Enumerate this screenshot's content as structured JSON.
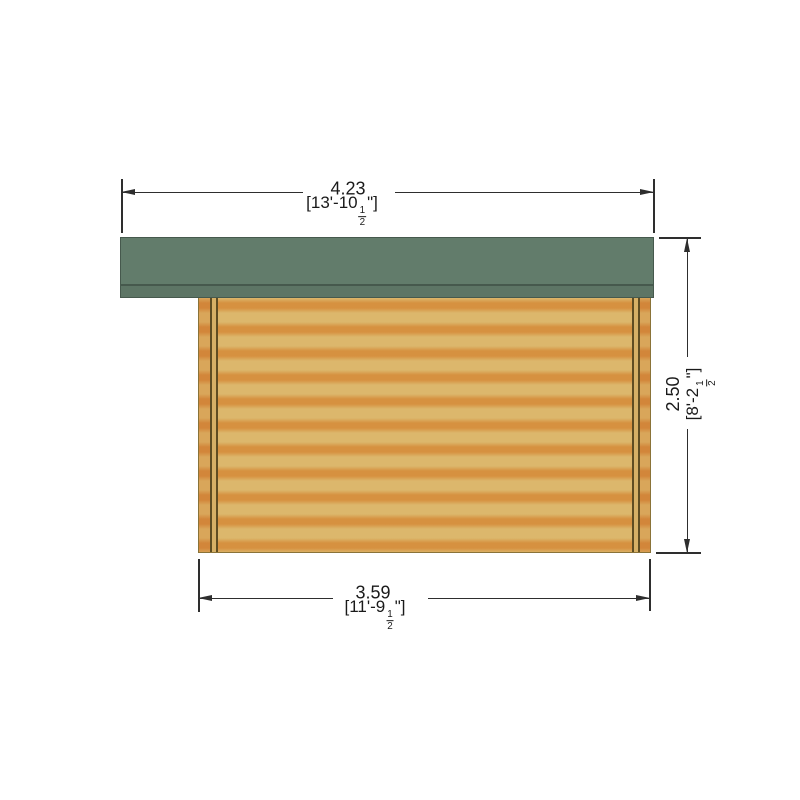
{
  "colors": {
    "background": "#ffffff",
    "roof": "#627c6b",
    "roof_fascia": "#5d7565",
    "roof_edge": "#46594d",
    "wall_light": "#dcb76c",
    "wall_dark": "#d69140",
    "wall_end_light": "#d9a65a",
    "wall_end_dark": "#d2863a",
    "wall_outline": "#8a7338",
    "groove_line": "#5f4d22",
    "groove_fill": "#d6b066",
    "dim": "#2e2e2e",
    "text": "#1a1a1a"
  },
  "dimensions": {
    "top_width": {
      "metric": "4.23",
      "imperial_prefix": "[13'-10",
      "fraction_numerator": "1",
      "fraction_denominator": "2",
      "imperial_suffix": "\"]"
    },
    "right_height": {
      "metric": "2.50",
      "imperial_prefix": "[8'-2",
      "fraction_numerator": "1",
      "fraction_denominator": "2",
      "imperial_suffix": "\"]"
    },
    "bottom_width": {
      "metric": "3.59",
      "imperial_prefix": "[11'-9",
      "fraction_numerator": "1",
      "fraction_denominator": "2",
      "imperial_suffix": "\"]"
    }
  }
}
